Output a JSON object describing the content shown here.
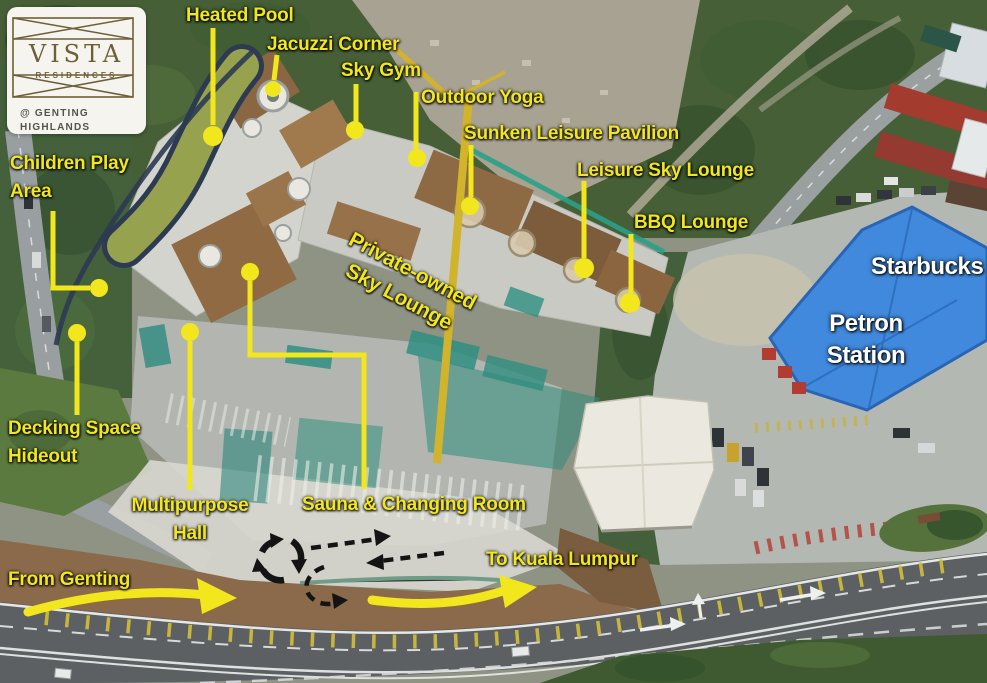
{
  "logo": {
    "name": "VISTA",
    "type": "RESIDENCES",
    "location_line1": "@ GENTING",
    "location_line2": "HIGHLANDS"
  },
  "amenities": {
    "heated_pool": "Heated Pool",
    "jacuzzi_corner": "Jacuzzi Corner",
    "sky_gym": "Sky Gym",
    "outdoor_yoga": "Outdoor Yoga",
    "sunken_leisure_pavilion": "Sunken Leisure Pavilion",
    "leisure_sky_lounge": "Leisure Sky Lounge",
    "bbq_lounge": "BBQ Lounge",
    "children_play_area": {
      "line1": "Children Play",
      "line2": "Area"
    },
    "private_owned_sky_lounge": {
      "line1": "Private-owned",
      "line2": "Sky Lounge"
    },
    "decking_space_hideout": {
      "line1": "Decking Space",
      "line2": "Hideout"
    },
    "multipurpose_hall": {
      "line1": "Multipurpose",
      "line2": "Hall"
    },
    "sauna_changing_room": "Sauna & Changing Room"
  },
  "landmarks": {
    "starbucks": "Starbucks",
    "petron_station": {
      "line1": "Petron",
      "line2": "Station"
    }
  },
  "traffic": {
    "from_genting": "From Genting",
    "to_kuala_lumpur": "To Kuala Lumpur"
  },
  "colors": {
    "annotation_yellow": "#f2e71c",
    "landmark_text_white": "#ffffff",
    "petron_roof_blue": "#4089dc",
    "pool_water_green": "#97a24e",
    "marker_black": "#141414",
    "logo_bronze": "#6e5f38"
  }
}
